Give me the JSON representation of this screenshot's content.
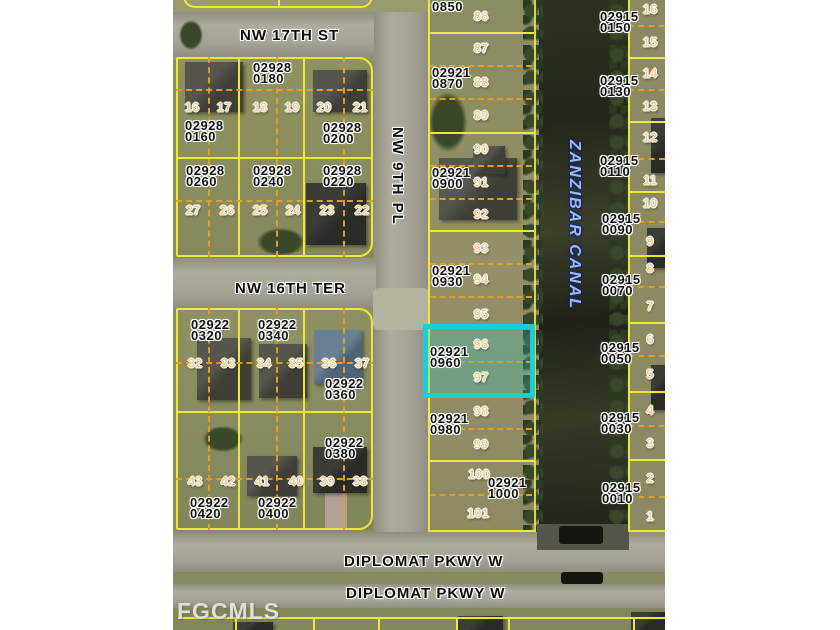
{
  "watermark": "FGCMLS",
  "map": {
    "streets": [
      {
        "name": "NW 17TH ST",
        "orientation": "horizontal",
        "x": 67,
        "y": 27
      },
      {
        "name": "NW 16TH TER",
        "orientation": "horizontal",
        "x": 62,
        "y": 280
      },
      {
        "name": "NW 9TH PL",
        "orientation": "vertical",
        "x": 216,
        "y": 127
      },
      {
        "name": "DIPLOMAT PKWY W",
        "orientation": "horizontal",
        "x": 171,
        "y": 553
      },
      {
        "name": "DIPLOMAT PKWY W",
        "orientation": "horizontal",
        "x": 173,
        "y": 585
      }
    ],
    "canal": {
      "name": "ZANZIBAR CANAL"
    },
    "highlight": {
      "parcel": "02921 0960",
      "lots": [
        "96",
        "97"
      ],
      "color": "#1fcbd4"
    },
    "parcels": [
      {
        "text": "02928\n0180",
        "x": 80,
        "y": 62
      },
      {
        "text": "02928\n0160",
        "x": 12,
        "y": 120
      },
      {
        "text": "02928\n0200",
        "x": 150,
        "y": 122
      },
      {
        "text": "02928\n0260",
        "x": 13,
        "y": 165
      },
      {
        "text": "02928\n0240",
        "x": 80,
        "y": 165
      },
      {
        "text": "02928\n0220",
        "x": 150,
        "y": 165
      },
      {
        "text": "02922\n0320",
        "x": 18,
        "y": 319
      },
      {
        "text": "02922\n0340",
        "x": 85,
        "y": 319
      },
      {
        "text": "02922\n0360",
        "x": 152,
        "y": 378
      },
      {
        "text": "02922\n0380",
        "x": 152,
        "y": 437
      },
      {
        "text": "02922\n0420",
        "x": 17,
        "y": 497
      },
      {
        "text": "02922\n0400",
        "x": 85,
        "y": 497
      },
      {
        "text": "0850",
        "x": 259,
        "y": 1
      },
      {
        "text": "02921\n0870",
        "x": 259,
        "y": 67
      },
      {
        "text": "02921\n0900",
        "x": 259,
        "y": 167
      },
      {
        "text": "02921\n0930",
        "x": 259,
        "y": 265
      },
      {
        "text": "02921\n0960",
        "x": 257,
        "y": 346
      },
      {
        "text": "02921\n0980",
        "x": 257,
        "y": 413
      },
      {
        "text": "02921\n1000",
        "x": 315,
        "y": 477
      },
      {
        "text": "02915\n0150",
        "x": 427,
        "y": 11
      },
      {
        "text": "02915\n0130",
        "x": 427,
        "y": 75
      },
      {
        "text": "02915\n0110",
        "x": 427,
        "y": 155
      },
      {
        "text": "02915\n0090",
        "x": 429,
        "y": 213
      },
      {
        "text": "02915\n0070",
        "x": 429,
        "y": 274
      },
      {
        "text": "02915\n0050",
        "x": 428,
        "y": 342
      },
      {
        "text": "02915\n0030",
        "x": 428,
        "y": 412
      },
      {
        "text": "02915\n0010",
        "x": 429,
        "y": 482
      }
    ],
    "lots": [
      {
        "n": "16",
        "x": 19,
        "y": 107
      },
      {
        "n": "17",
        "x": 51,
        "y": 107
      },
      {
        "n": "18",
        "x": 87,
        "y": 107
      },
      {
        "n": "19",
        "x": 119,
        "y": 107
      },
      {
        "n": "20",
        "x": 151,
        "y": 107
      },
      {
        "n": "21",
        "x": 187,
        "y": 107
      },
      {
        "n": "27",
        "x": 20,
        "y": 210
      },
      {
        "n": "26",
        "x": 54,
        "y": 210
      },
      {
        "n": "25",
        "x": 87,
        "y": 210
      },
      {
        "n": "24",
        "x": 120,
        "y": 210
      },
      {
        "n": "23",
        "x": 154,
        "y": 210
      },
      {
        "n": "22",
        "x": 189,
        "y": 210
      },
      {
        "n": "32",
        "x": 22,
        "y": 363
      },
      {
        "n": "33",
        "x": 55,
        "y": 363
      },
      {
        "n": "34",
        "x": 91,
        "y": 363
      },
      {
        "n": "35",
        "x": 123,
        "y": 363
      },
      {
        "n": "36",
        "x": 156,
        "y": 363
      },
      {
        "n": "37",
        "x": 189,
        "y": 363
      },
      {
        "n": "43",
        "x": 22,
        "y": 481
      },
      {
        "n": "42",
        "x": 55,
        "y": 481
      },
      {
        "n": "41",
        "x": 89,
        "y": 481
      },
      {
        "n": "40",
        "x": 123,
        "y": 481
      },
      {
        "n": "39",
        "x": 154,
        "y": 481
      },
      {
        "n": "38",
        "x": 187,
        "y": 481
      },
      {
        "n": "86",
        "x": 308,
        "y": 16
      },
      {
        "n": "87",
        "x": 308,
        "y": 48
      },
      {
        "n": "88",
        "x": 308,
        "y": 82
      },
      {
        "n": "89",
        "x": 308,
        "y": 115
      },
      {
        "n": "90",
        "x": 308,
        "y": 149
      },
      {
        "n": "91",
        "x": 308,
        "y": 182
      },
      {
        "n": "92",
        "x": 308,
        "y": 214
      },
      {
        "n": "93",
        "x": 308,
        "y": 248
      },
      {
        "n": "94",
        "x": 308,
        "y": 279
      },
      {
        "n": "95",
        "x": 308,
        "y": 314
      },
      {
        "n": "96",
        "x": 308,
        "y": 344
      },
      {
        "n": "97",
        "x": 308,
        "y": 377
      },
      {
        "n": "98",
        "x": 308,
        "y": 411
      },
      {
        "n": "99",
        "x": 308,
        "y": 444
      },
      {
        "n": "100",
        "x": 306,
        "y": 474
      },
      {
        "n": "101",
        "x": 305,
        "y": 513
      },
      {
        "n": "16",
        "x": 477,
        "y": 9
      },
      {
        "n": "15",
        "x": 477,
        "y": 42
      },
      {
        "n": "14",
        "x": 477,
        "y": 73
      },
      {
        "n": "13",
        "x": 477,
        "y": 106
      },
      {
        "n": "12",
        "x": 477,
        "y": 137
      },
      {
        "n": "11",
        "x": 477,
        "y": 180
      },
      {
        "n": "10",
        "x": 477,
        "y": 203
      },
      {
        "n": "9",
        "x": 477,
        "y": 241
      },
      {
        "n": "8",
        "x": 477,
        "y": 268
      },
      {
        "n": "7",
        "x": 477,
        "y": 306
      },
      {
        "n": "6",
        "x": 477,
        "y": 339
      },
      {
        "n": "5",
        "x": 477,
        "y": 374
      },
      {
        "n": "4",
        "x": 477,
        "y": 410
      },
      {
        "n": "3",
        "x": 477,
        "y": 443
      },
      {
        "n": "2",
        "x": 477,
        "y": 478
      },
      {
        "n": "1",
        "x": 477,
        "y": 516
      }
    ]
  }
}
